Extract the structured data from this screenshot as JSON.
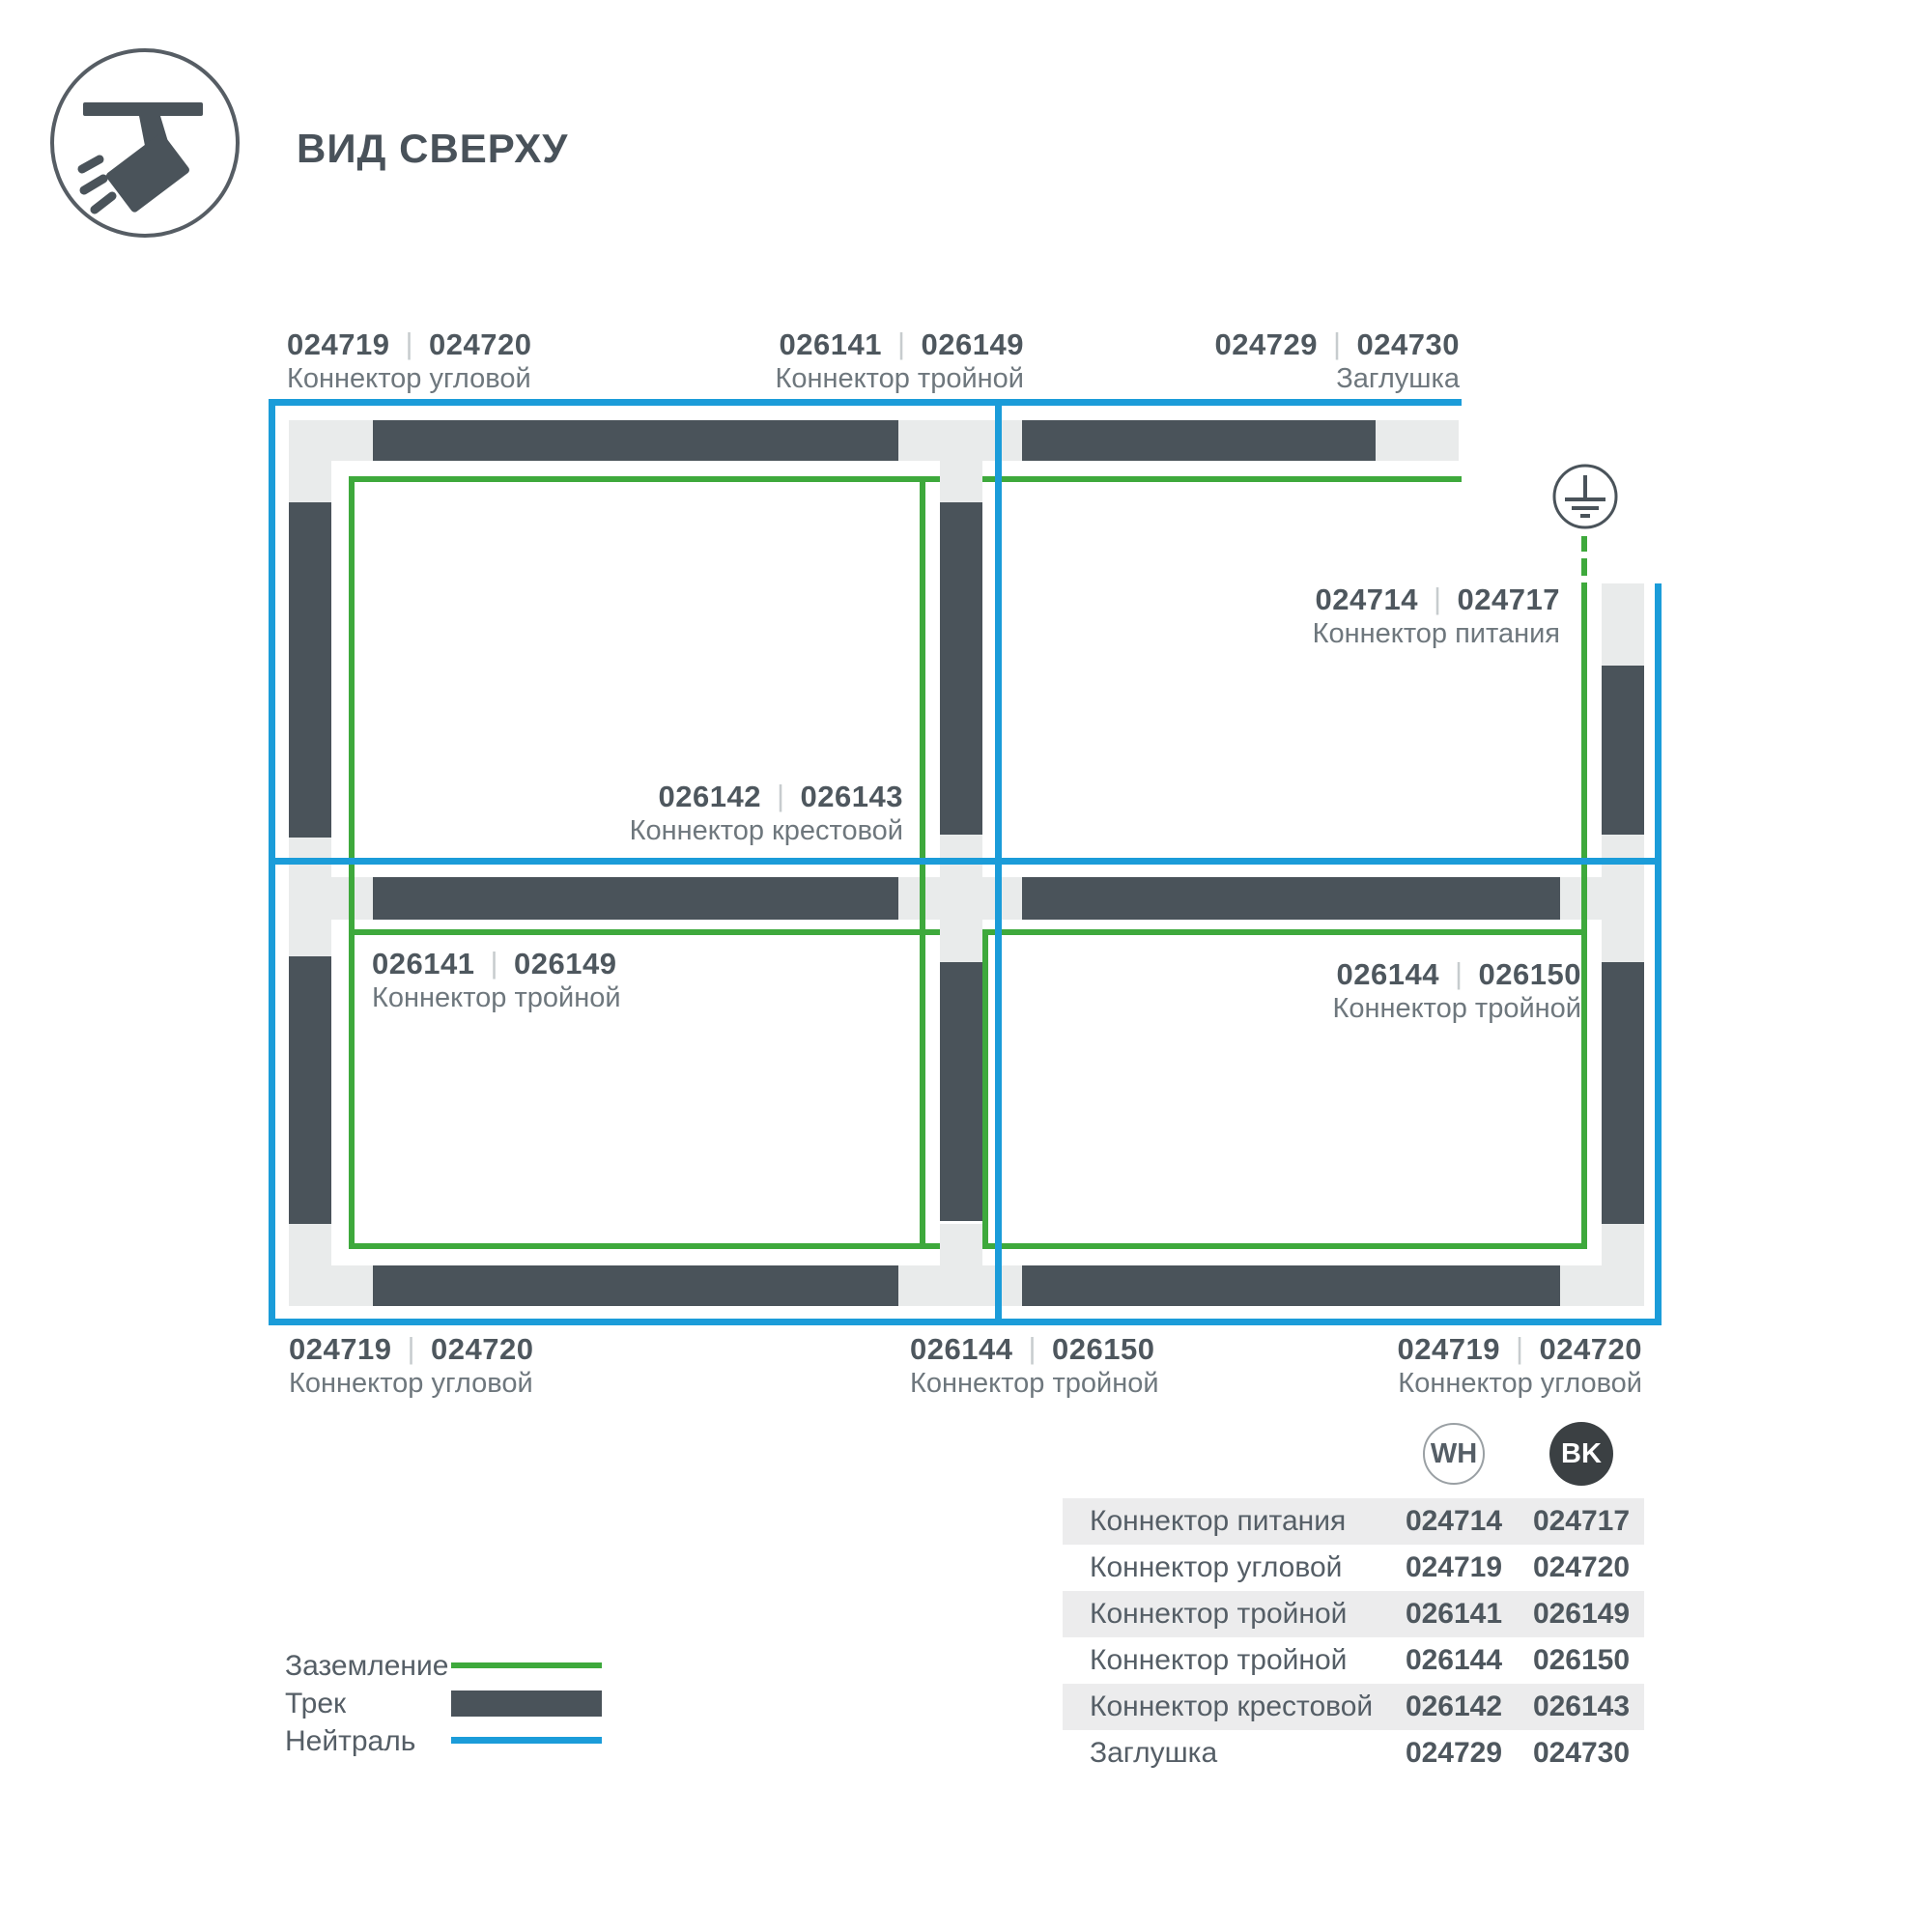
{
  "colors": {
    "track": "#4a535a",
    "connector": "#e9ebeb",
    "green": "#3ea93c",
    "blue": "#1b9cd9",
    "ink": "#49525a",
    "code": "#4e575e",
    "muted": "#6e777d",
    "sep": "#c7ccce",
    "rowbg": "#ececed",
    "bk": "#3b4043",
    "circle": "#9aa0a4",
    "tabletext": "#555e66"
  },
  "shared": {
    "sep": "|"
  },
  "header": {
    "title": "ВИД СВЕРХУ",
    "icon": "track-spotlight-icon"
  },
  "diagram": {
    "ground_symbol": "earth-ground-icon",
    "legend_lines": {
      "ground": "green",
      "neutral": "blue",
      "track": "dark"
    },
    "labels": [
      {
        "wh": "024719",
        "bk": "024720",
        "name": "Коннектор угловой"
      },
      {
        "wh": "026141",
        "bk": "026149",
        "name": "Коннектор тройной"
      },
      {
        "wh": "024729",
        "bk": "024730",
        "name": "Заглушка"
      },
      {
        "wh": "024714",
        "bk": "024717",
        "name": "Коннектор питания"
      },
      {
        "wh": "026142",
        "bk": "026143",
        "name": "Коннектор крестовой"
      },
      {
        "wh": "026141",
        "bk": "026149",
        "name": "Коннектор тройной"
      },
      {
        "wh": "026144",
        "bk": "026150",
        "name": "Коннектор тройной"
      },
      {
        "wh": "024719",
        "bk": "024720",
        "name": "Коннектор угловой"
      },
      {
        "wh": "026144",
        "bk": "026150",
        "name": "Коннектор тройной"
      },
      {
        "wh": "024719",
        "bk": "024720",
        "name": "Коннектор угловой"
      }
    ]
  },
  "legend": {
    "items": [
      {
        "label": "Заземление",
        "swatch": "ground-line"
      },
      {
        "label": "Трек",
        "swatch": "track-bar"
      },
      {
        "label": "Нейтраль",
        "swatch": "neutral-line"
      }
    ]
  },
  "table": {
    "badges": [
      {
        "label": "WH"
      },
      {
        "label": "BK"
      }
    ],
    "rows": [
      {
        "name": "Коннектор питания",
        "wh": "024714",
        "bk": "024717"
      },
      {
        "name": "Коннектор угловой",
        "wh": "024719",
        "bk": "024720"
      },
      {
        "name": "Коннектор тройной",
        "wh": "026141",
        "bk": "026149"
      },
      {
        "name": "Коннектор тройной",
        "wh": "026144",
        "bk": "026150"
      },
      {
        "name": "Коннектор крестовой",
        "wh": "026142",
        "bk": "026143"
      },
      {
        "name": "Заглушка",
        "wh": "024729",
        "bk": "024730"
      }
    ]
  }
}
